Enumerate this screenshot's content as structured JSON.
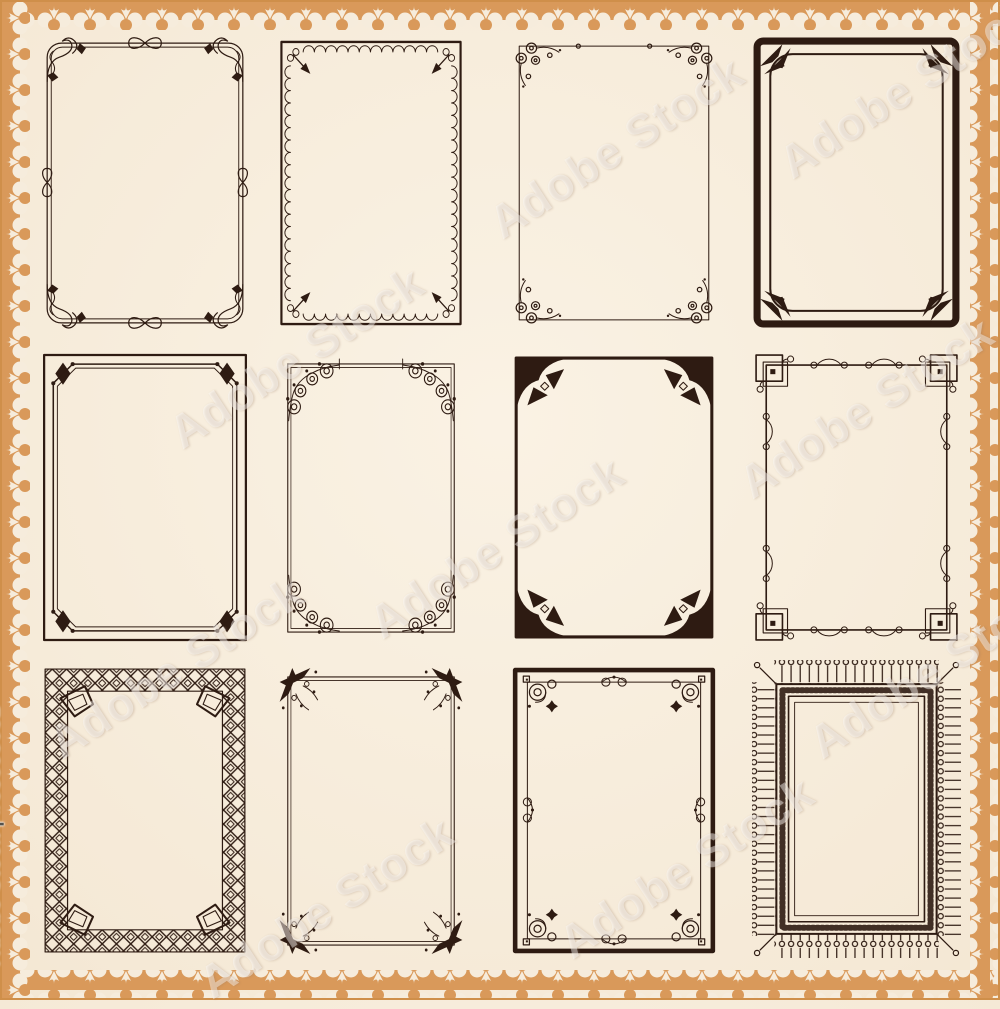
{
  "artwork": {
    "type": "vector-frame-set",
    "title": "Decorative vintage frames and borders set",
    "background_color": "#f5e9d6",
    "ink_color": "#2e1b12",
    "border_accent_color": "#d9995a",
    "grid": {
      "rows": 3,
      "columns": 4,
      "frame_count": 12
    }
  },
  "watermark": {
    "tile_text": "Adobe Stock",
    "credit_text": "Adobe Stock | #63598082"
  },
  "frames": [
    {
      "index": 1,
      "row": 1,
      "col": 1,
      "style": "double-line frame with loop flourishes and leaf corners"
    },
    {
      "index": 2,
      "row": 1,
      "col": 2,
      "style": "bordered frame with inner scallop edge, corner rings and arrows"
    },
    {
      "index": 3,
      "row": 1,
      "col": 3,
      "style": "thin frame with spiral filigree corners"
    },
    {
      "index": 4,
      "row": 1,
      "col": 4,
      "style": "art deco thick rounded frame with corner fans"
    },
    {
      "index": 5,
      "row": 2,
      "col": 1,
      "style": "octagonal double-line inset frame with fleur corners"
    },
    {
      "index": 6,
      "row": 2,
      "col": 2,
      "style": "double-line frame with floral scroll quarter-arc corners"
    },
    {
      "index": 7,
      "row": 2,
      "col": 3,
      "style": "bold frame with solid scalloped corners and ribbon bows"
    },
    {
      "index": 8,
      "row": 2,
      "col": 4,
      "style": "geometric frame with interlocked square corners and swirl accents"
    },
    {
      "index": 9,
      "row": 3,
      "col": 1,
      "style": "celtic knotwork chain frame"
    },
    {
      "index": 10,
      "row": 3,
      "col": 2,
      "style": "double-line frame with winged acanthus corners"
    },
    {
      "index": 11,
      "row": 3,
      "col": 3,
      "style": "bold frame with spiral corner medallions and edge accents"
    },
    {
      "index": 12,
      "row": 3,
      "col": 4,
      "style": "lace frame with outward pin fringe and patterned band"
    }
  ]
}
